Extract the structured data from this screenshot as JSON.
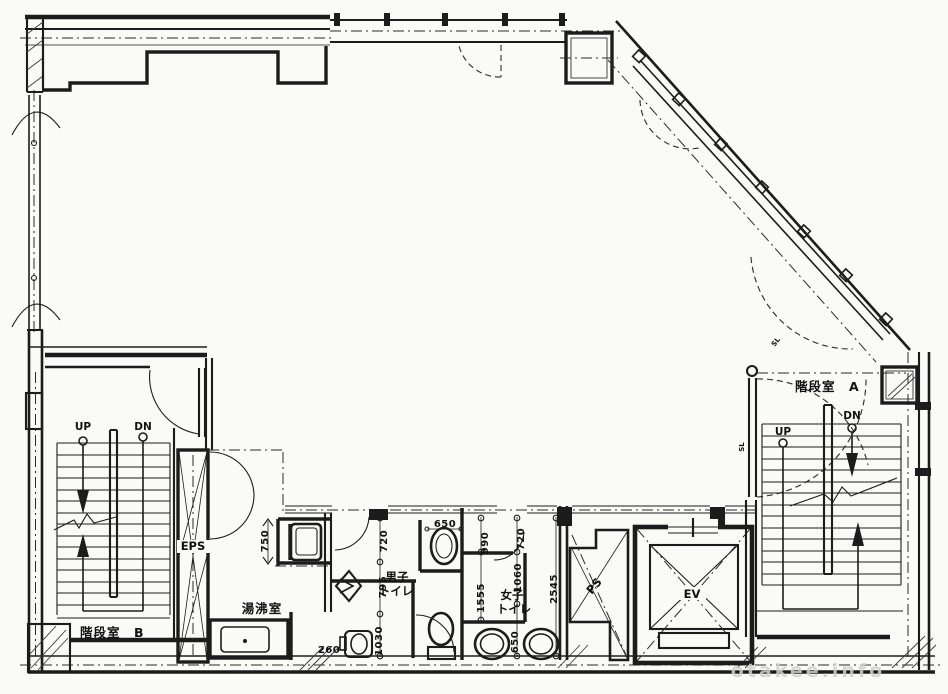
{
  "plan": {
    "rooms": {
      "stairwell_b": {
        "label": "階段室　B"
      },
      "stairwell_a": {
        "label": "階段室　A"
      },
      "kitchenette": {
        "label": "湯沸室"
      },
      "mens_toilet": {
        "line1": "男子",
        "line2": "トイレ"
      },
      "womens_toilet": {
        "line1": "女子",
        "line2": "トイレ"
      },
      "eps_shaft": {
        "label": "EPS"
      },
      "ps_shaft": {
        "label": "PS"
      },
      "elevator": {
        "label": "EV"
      }
    },
    "stair_marks": {
      "b_up": "UP",
      "b_dn": "DN",
      "a_up": "UP",
      "a_dn": "DN"
    },
    "dimensions_mm": {
      "kitchen_sink_width": "750",
      "mens_bay1": "720",
      "mens_bay2": "795",
      "mens_bay3": "1030",
      "mens_basin_width": "650",
      "kitchen_passage": "260",
      "womens_bay1": "990",
      "womens_bay2": "720",
      "womens_bay3": "1060",
      "womens_stall": "1555",
      "womens_depth": "2545",
      "womens_fixture": "650"
    },
    "notes": {
      "sl_1": "SL",
      "sl_2": "SL"
    },
    "watermark": "otakee.info",
    "colors": {
      "ink": "#1c1c1c",
      "paper": "#fafaf7",
      "watermark": "#d2d2cc"
    }
  }
}
